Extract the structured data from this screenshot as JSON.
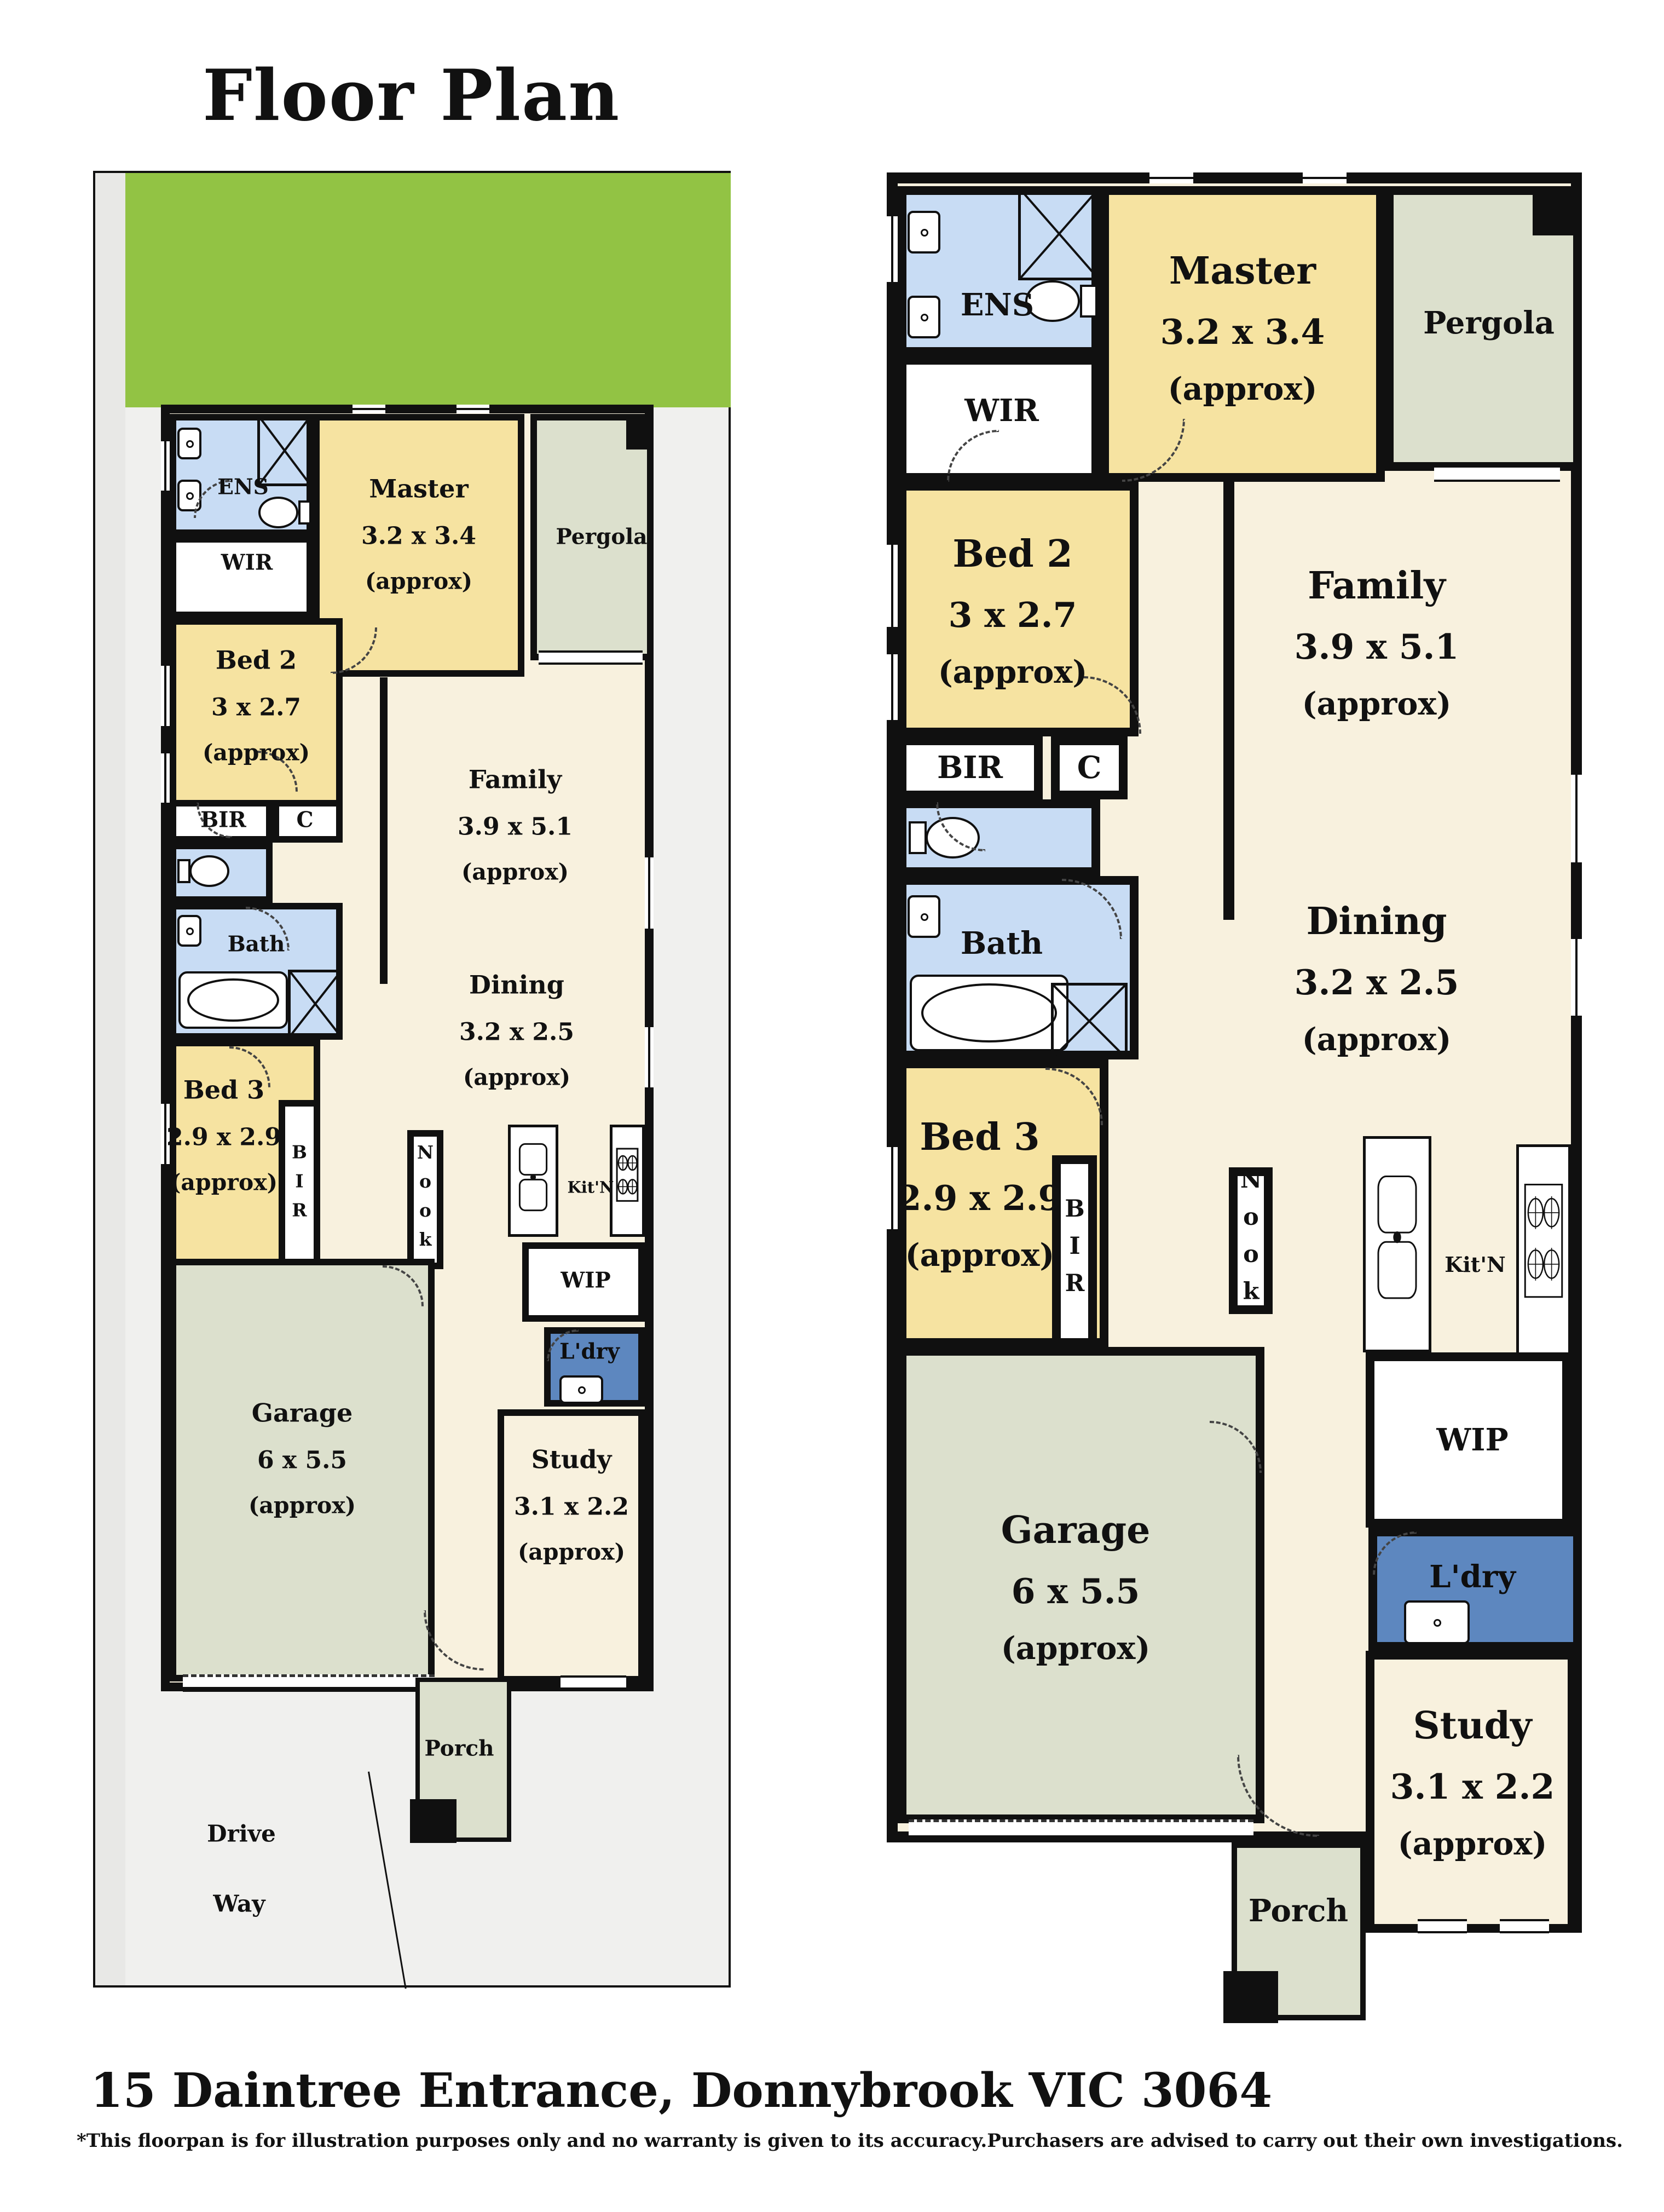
{
  "title": "Floor Plan",
  "address": "15 Daintree Entrance, Donnybrook VIC 3064",
  "disclaimer": "*This floorpan is for illustration purposes only and no warranty is given to its accuracy.Purchasers are advised to carry out their own investigations.",
  "colors": {
    "wall": "#101010",
    "bedroom_yellow": "#f6e3a1",
    "living_cream": "#f8f1de",
    "wet_area_blue": "#c8dcf4",
    "laundry_blue": "#5d87bf",
    "outdoor_grey_green": "#dce0cd",
    "yard_green": "#92c344",
    "lot_grey": "#f0f0ee",
    "text": "#111111"
  },
  "icons": {
    "shower": "x-box-shower",
    "toilet": "toilet-pan",
    "bath": "bathtub",
    "basin": "vanity-basin",
    "stove": "four-burner-cooktop",
    "kitchen_sink": "double-bowl-sink",
    "trough": "laundry-trough"
  },
  "rooms": {
    "master": {
      "name": "Master",
      "dims": "3.2 x 3.4",
      "approx": "(approx)"
    },
    "bed2": {
      "name": "Bed 2",
      "dims": "3 x 2.7",
      "approx": "(approx)"
    },
    "bed3": {
      "name": "Bed 3",
      "dims": "2.9 x 2.9",
      "approx": "(approx)"
    },
    "family": {
      "name": "Family",
      "dims": "3.9 x 5.1",
      "approx": "(approx)"
    },
    "dining": {
      "name": "Dining",
      "dims": "3.2 x 2.5",
      "approx": "(approx)"
    },
    "garage": {
      "name": "Garage",
      "dims": "6 x 5.5",
      "approx": "(approx)"
    },
    "study": {
      "name": "Study",
      "dims": "3.1 x 2.2",
      "approx": "(approx)"
    },
    "pergola": {
      "name": "Pergola"
    },
    "ens": {
      "name": "ENS"
    },
    "wir": {
      "name": "WIR"
    },
    "bir": {
      "name": "BIR"
    },
    "c": {
      "name": "C"
    },
    "bath": {
      "name": "Bath"
    },
    "nook": {
      "name": "Nook"
    },
    "kitn": {
      "name": "Kit'N"
    },
    "wip": {
      "name": "WIP"
    },
    "ldry": {
      "name": "L'dry"
    },
    "porch": {
      "name": "Porch"
    },
    "driveway": {
      "line1": "Drive",
      "line2": "Way"
    }
  }
}
